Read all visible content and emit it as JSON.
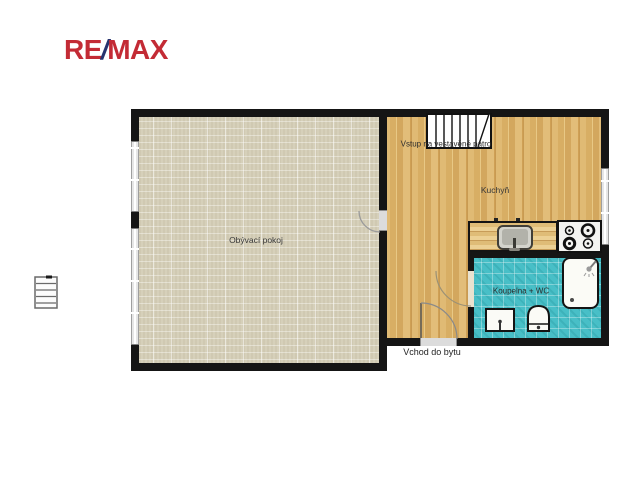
{
  "brand": {
    "re": "RE",
    "slash": "/",
    "max": "MAX"
  },
  "floorplan": {
    "living_room": {
      "label": "Obývací pokoj"
    },
    "kitchen": {
      "label": "Kuchyň"
    },
    "bathroom": {
      "label": "Koupelna + WC"
    },
    "stairs_note": {
      "label": "Vstup na vestavěné patro"
    },
    "entrance_note": {
      "label": "Vchod do bytu"
    },
    "icons": [
      "stairs-icon",
      "ladder-icon",
      "kitchen-sink-icon",
      "stove-icon",
      "bathtub-icon",
      "shower-head-icon",
      "washbasin-icon",
      "toilet-icon",
      "door-arc-icon",
      "window-icon"
    ],
    "colors": {
      "wall": "#151515",
      "living_floor": "#d6d0ba",
      "wood_floor": "#dcb46c",
      "bath_floor": "#48bfc7",
      "counter": "#e6c787",
      "brand_red": "#c32b35",
      "brand_blue": "#27336e"
    }
  }
}
